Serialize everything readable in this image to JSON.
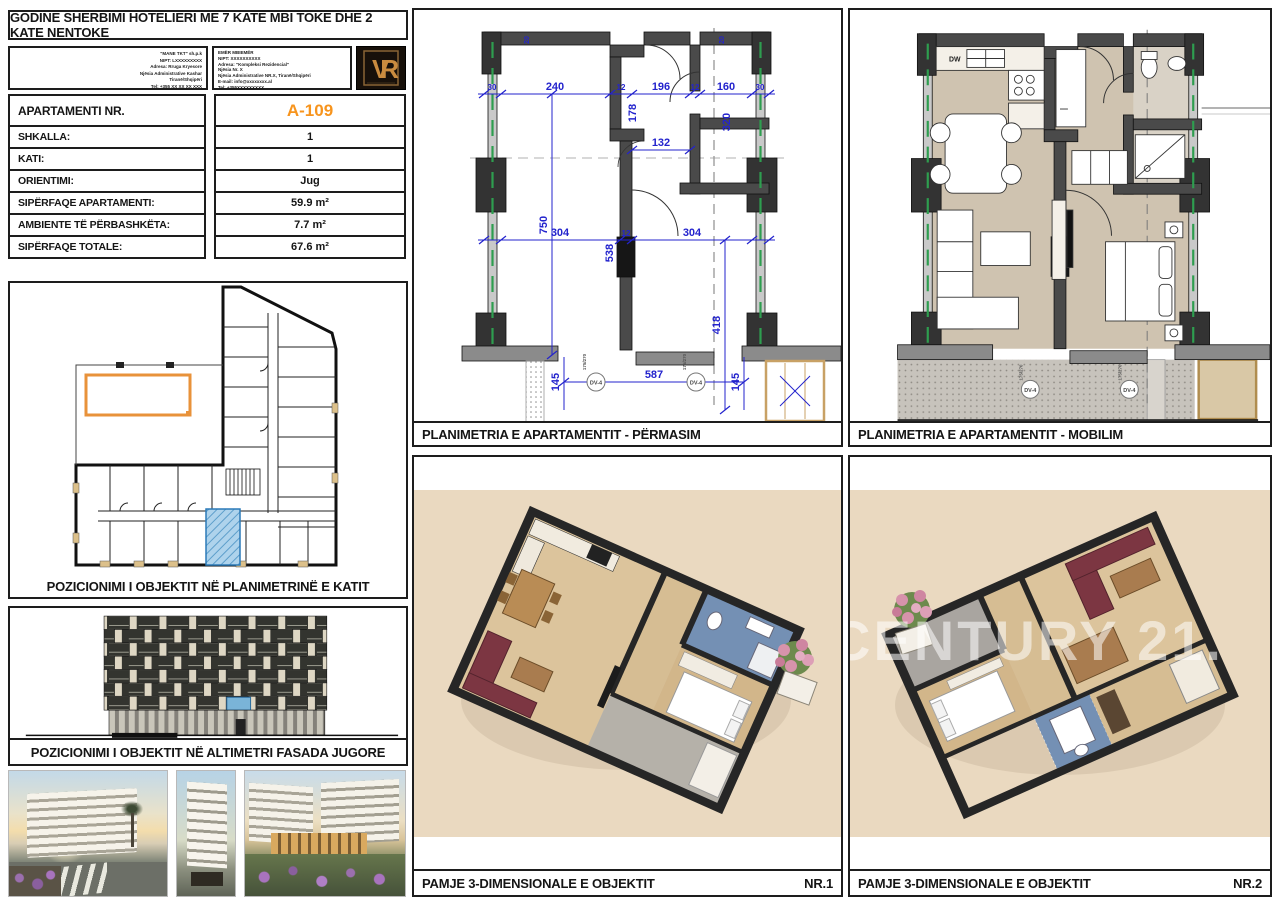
{
  "sheet": {
    "title": "GODINE SHERBIMI HOTELIERI ME 7 KATE MBI TOKE DHE 2 KATE NENTOKE",
    "logo_monogram": "VR"
  },
  "company_blocks": {
    "left_lines": [
      "\"MANE TKT\" sh.p.k",
      "NIPT: LXXXXXXXXX",
      "Adresa: Rruga Kryesore",
      "Njësia Administrative Kashar",
      "Tiranë/Shqipëri",
      "Tel: +355 XX XX XX XXX"
    ],
    "right_lines": [
      "EMËR MBIEMËR",
      "NIPT: XXXXXXXXXX",
      "Adresa: \"Kompleksi Rezidencial\"",
      "Njësia Nr. X",
      "Njësia Administrative NR.X, Tiranë/Shqipëri",
      "E-mail: info@xxxxxxxx.al",
      "Tel: +355XXXXXXXXX"
    ]
  },
  "spec_table": {
    "rows": [
      {
        "label": "APARTAMENTI NR.",
        "value": "A-109"
      },
      {
        "label": "SHKALLA:",
        "value": "1"
      },
      {
        "label": "KATI:",
        "value": "1"
      },
      {
        "label": "ORIENTIMI:",
        "value": "Jug"
      },
      {
        "label": "SIPËRFAQE APARTAMENTI:",
        "value": "59.9 m²"
      },
      {
        "label": "AMBIENTE TË PËRBASHKËTA:",
        "value": "7.7 m²"
      },
      {
        "label": "SIPËRFAQE TOTALE:",
        "value": "67.6 m²"
      }
    ],
    "accent_color": "#f7941d"
  },
  "captions": {
    "key_plan": "POZICIONIMI I OBJEKTIT NË PLANIMETRINË E KATIT",
    "facade": "POZICIONIMI I OBJEKTIT NË ALTIMETRI FASADA JUGORE",
    "plan_dim": "PLANIMETRIA E APARTAMENTIT - PËRMASIM",
    "plan_furnished": "PLANIMETRIA E APARTAMENTIT - MOBILIM",
    "view3d": "PAMJE 3-DIMENSIONALE E OBJEKTIT",
    "nr1": "NR.1",
    "nr2": "NR.2"
  },
  "plan_dimensions": {
    "top_row": [
      "30",
      "240",
      "12",
      "196",
      "12",
      "160",
      "30"
    ],
    "hall_width": "132",
    "living_height": "750",
    "kitchen_return": "178",
    "wc_depth": "320",
    "bottom_304_left": "304",
    "bottom_538": "538",
    "bottom_12": "12",
    "bottom_304_right": "304",
    "bedroom_depth": "418",
    "terrace_width": "587",
    "terrace_depth_left": "145",
    "terrace_depth_right": "145",
    "door_mark_left": "175/270",
    "door_mark_right": "175/270",
    "window_tag_left": "DV-4",
    "window_tag_right": "DV-4",
    "small_top_left": "20",
    "small_top_right": "20"
  },
  "furnished_plan": {
    "dw_label": "DW"
  },
  "watermark": {
    "text": "CENTURY 21."
  },
  "colors": {
    "dimension_blue": "#2323cd",
    "wall_dark": "#4a4a4a",
    "accent_orange": "#f7941d",
    "highlight_blue": "#aed3ec",
    "floor_beige": "#cfc3b0",
    "bg_3d": "#ead9c0",
    "window_green": "#2e9e4f"
  }
}
